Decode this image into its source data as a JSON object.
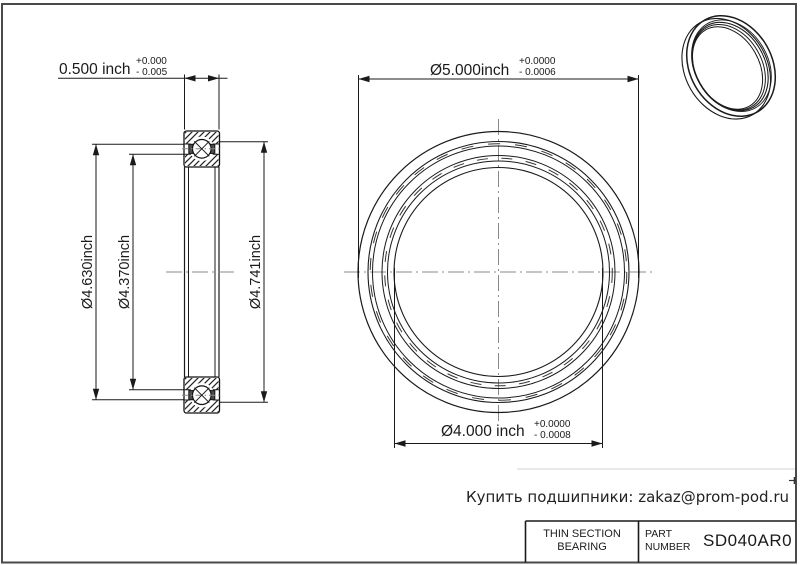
{
  "drawing": {
    "section_view": {
      "width_dim": {
        "value": "0.500 inch",
        "tol_plus": "+0.000",
        "tol_minus": "- 0.005"
      },
      "dim_4630": "Ø4.630inch",
      "dim_4370": "Ø4.370inch",
      "dim_4741": "Ø4.741inch"
    },
    "front_view": {
      "od_dim": {
        "value": "Ø5.000inch",
        "tol_plus": "+0.0000",
        "tol_minus": "- 0.0006"
      },
      "bore_dim": {
        "value": "Ø4.000 inch",
        "tol_plus": "+0.0000",
        "tol_minus": "- 0.0008"
      }
    }
  },
  "contact_line": "Купить подшипники: zakaz@prom-pod.ru",
  "title_block": {
    "type_line1": "THIN SECTION",
    "type_line2": "BEARING",
    "part_label_line1": "PART",
    "part_label_line2": "NUMBER",
    "part_number": "SD040AR0"
  },
  "colors": {
    "line": "#1a1a1a",
    "centerline": "#8a8a8a",
    "seal_fill": "#4d4d4d",
    "frame": "#4a4a4a",
    "faint_rule": "#e2e2e2",
    "background": "#ffffff"
  }
}
